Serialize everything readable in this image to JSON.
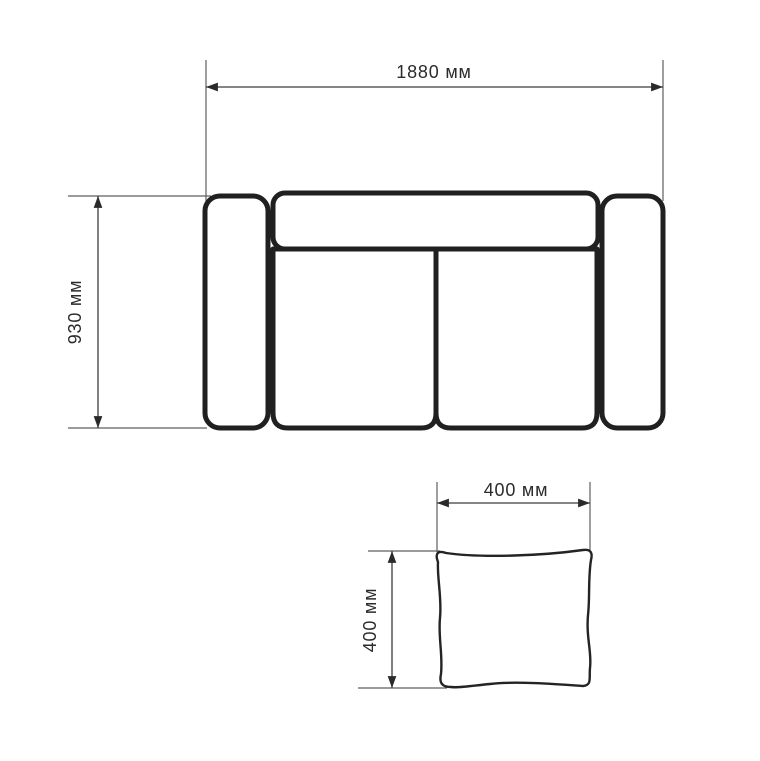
{
  "colors": {
    "background": "#ffffff",
    "furniture_outline": "#202020",
    "dimension_line": "#3c3c3c",
    "extension_line": "#5f5f5f",
    "label_text": "#2b2b2b"
  },
  "sofa": {
    "width": {
      "value": 1880,
      "unit": "мм",
      "label": "1880 мм"
    },
    "height": {
      "value": 930,
      "unit": "мм",
      "label": "930 мм"
    }
  },
  "pillow": {
    "width": {
      "value": 400,
      "unit": "мм",
      "label": "400 мм"
    },
    "height": {
      "value": 400,
      "unit": "мм",
      "label": "400 мм"
    }
  }
}
